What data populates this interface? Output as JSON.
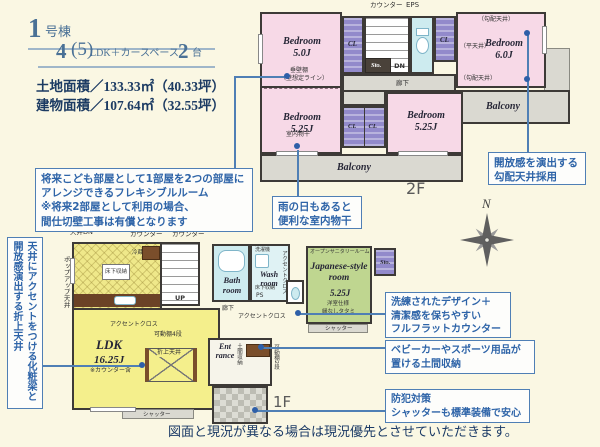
{
  "header": {
    "building_num": "1",
    "building_suffix": "号棟",
    "plan_num": "4",
    "plan_paren": "(5)",
    "plan_text": "LDK＋カースペース",
    "plan_num2": "2",
    "plan_suffix": "台",
    "land_area": "土地面積／133.33㎡（40.33坪）",
    "building_area": "建物面積／107.64㎡（32.55坪）"
  },
  "callouts": {
    "flexible": "将来こども部屋として1部屋を2つの部屋に\nアレンジできるフレキシブルルーム\n※将来2部屋として利用の場合、\n間仕切壁工事は有償となります",
    "drying": "雨の日もあると\n便利な室内物干",
    "sloped": "開放感を演出する\n勾配天井採用",
    "folded": "天井にアクセントをつける化粧梁と\n開放感演出する折上天井",
    "flat_counter": "洗練されたデザイン＋\n清潔感を保ちやすい\nフルフラットカウンター",
    "doma": "ベビーカーやスポーツ用品が\n置ける土間収納",
    "security": "防犯対策\nシャッターも標準装備で安心"
  },
  "floor2": {
    "label": "2F",
    "counter_label": "カウンター",
    "eps_label": "EPS",
    "bedroom1_name": "Bedroom",
    "bedroom1_size": "5.0J",
    "bedroom2_name": "Bedroom",
    "bedroom2_size": "5.25J",
    "bedroom3_name": "Bedroom",
    "bedroom3_size": "5.25J",
    "bedroom4_name": "Bedroom",
    "bedroom4_size": "6.0J",
    "cl": "CL",
    "dn": "DN",
    "sto": "Sto.",
    "hall": "廊下",
    "balcony": "Balcony",
    "sloped_ceiling": "（勾配天井）",
    "flat_ceiling": "（平天井）",
    "hanging_wall": "垂壁棚",
    "wall_line": "（壁想定ライン）",
    "indoor_drying": "室内物干"
  },
  "floor1": {
    "label": "1F",
    "ceiling_dn": "天井DN",
    "counter1": "カウンター",
    "counter2": "カウンター",
    "popup_ceiling": "ポップアップ天井",
    "fridge": "冷蔵庫",
    "floor_storage": "床下収納",
    "accent_cloth": "アクセントクロス",
    "ldk_name": "LDK",
    "ldk_size": "16.25J",
    "ldk_note": "※カウンター含",
    "folded_box": "折上天井",
    "shelf4": "可動棚4段",
    "up": "UP",
    "bath_name": "Bath room",
    "wash_name": "Wash room",
    "laundry": "洗濯機",
    "ps": "PS",
    "hall": "廊下",
    "open_sanitary": "オープンサニタリールーム",
    "jp_room_name": "Japanese-style room",
    "jp_room_size": "5.25J",
    "jp_spec1": "洋室仕様",
    "jp_spec2": "縁なしタタミ",
    "sto": "Sto.",
    "entrance": "Ent rance",
    "doma": "土間収納",
    "shelf2": "可動棚2段",
    "shutter": "シャッター"
  },
  "compass_n": "N",
  "disclaimer": "図面と現況が異なる場合は現況優先とさせていただきます。"
}
